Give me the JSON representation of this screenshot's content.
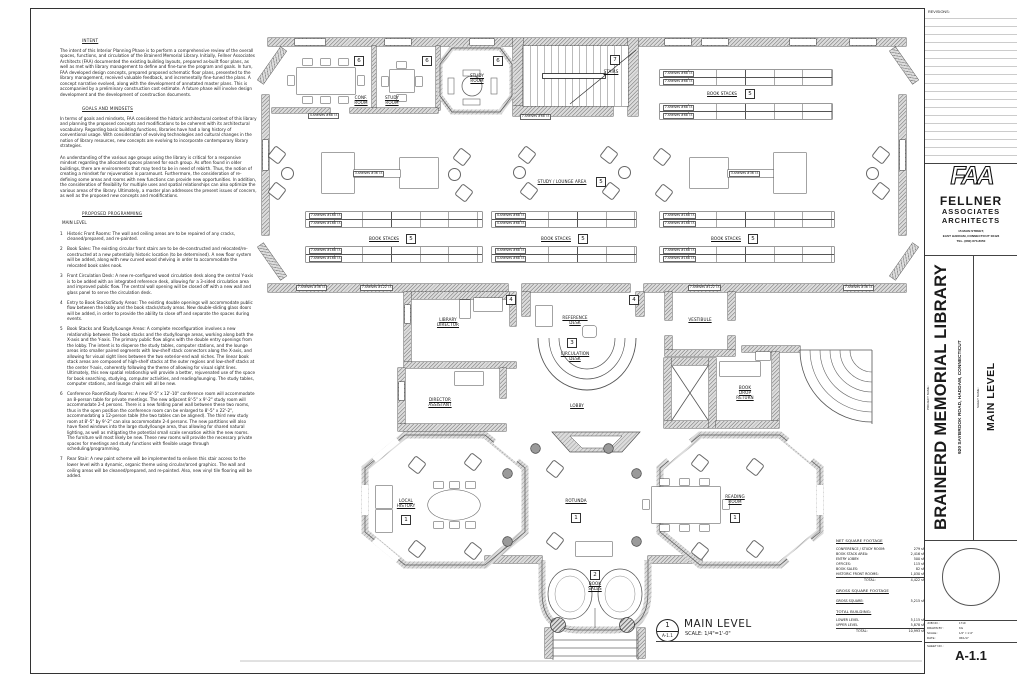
{
  "narrative": {
    "intent_heading": "INTENT",
    "intent_body": "The intent of this Interior Planning Phase is to perform a comprehensive review of the overall spaces, functions, and circulation of the Brainerd Memorial Library.  Initially, Fellner Associates Architects (FAA) documented the existing building layouts, prepared as-built floor plans, as well as met with library management to define and fine-tune the program and goals.  In turn, FAA developed design concepts, prepared proposed schematic floor plans, presented to the library management, received valuable feedback, and incrementally fine-tuned the plans.  A concept narrative evolved, along with the development of annotated master plans.  This is accompanied by a preliminary construction cost estimate.  A future phase will involve design development and the development of construction documents.",
    "goals_heading": "GOALS AND MINDSETS",
    "goals_body_1": "In terms of goals and mindsets, FAA considered the historic architectural context of this library and planning the proposed concepts and modifications to be coherent with its architectural vocabulary.  Regarding basic building functions, libraries have had a long history of conventional usage.  With consideration of evolving technologies and cultural changes in the notion of library resources, new concepts are evolving to incorporate contemporary library strategies.",
    "goals_body_2": "An understanding of the various age groups using the library is critical for a responsive mindset regarding the allocated spaces planned for each group.  As often found in older buildings, there are environments that may tend to be in need of rebirth.  Thus, the notion of creating a mindset for rejuvenation is paramount.  Furthermore, the consideration of re-defining some areas and rooms with new functions can provide new opportunities.  In addition, the consideration of flexibility for multiple uses and spatial relationships can also optimize the various areas of the library.  Ultimately, a master plan addresses the present issues of concern, as well as the proposed new concepts and modifications.",
    "programming_heading": "PROPOSED PROGRAMMING",
    "main_level_heading": "MAIN LEVEL",
    "items": [
      {
        "n": "1",
        "t": "Historic Front Rooms:  The wall and ceiling areas are to be repaired of any cracks, cleaned/prepared, and re-painted."
      },
      {
        "n": "2",
        "t": "Book Sales:  The existing circular front stairs are to be de-constructed and relocated/re-constructed at a new potentially historic location (to be determined).  A new floor system will be added, along with new curved wood shelving in order to accommodate the relocated book sales nook."
      },
      {
        "n": "3",
        "t": "Front Circulation Desk:  A new re-configured wood circulation desk along the central Y-axis is to be added with an integrated reference desk, allowing for a 3-sided circulation area and improved public flow.  The central wall opening will be closed off with a new wall and glass panel to serve the circulation desk."
      },
      {
        "n": "4",
        "t": "Entry to Book Stacks/Study Areas:  The existing double openings will accommodate public flow between the lobby and the book stacks/study areas.  New double-sliding glass doors will be added, in order to provide the ability to close off and separate the spaces during events."
      },
      {
        "n": "5",
        "t": "Book Stacks and Study/Lounge Areas:  A complete reconfiguration involves a new relationship between the book stacks and the study/lounge areas, working along both the X-axis and the Y-axis.  The primary public flow aligns with the double entry openings from the lobby.  The intent is to disperse the study tables, computer stations, and the lounge areas into smaller paired segments with low-shelf stack connectors along the X-axis, and allowing for visual sight lines between the two exterior-end wall niches.  The linear book stack areas are composed of high-shelf stacks at the outer regions and low-shelf stacks at the center Y-axis, coherently following the theme of allowing for visual sight lines.  Ultimately, this new spatial relationship will provide a better, rejuvenated use of the space for book searching, studying, computer activities, and reading/lounging.  The study tables, computer stations, and lounge chairs will all be new."
      },
      {
        "n": "6",
        "t": "Conference Room/Study Rooms:  A new 8'-5\" x 12'-10\" conference room will accommodate an 8-person table for private meetings.  The new adjacent 8'-5\" x 9'-2\" study room will accommodate 2-4 persons.  There is a new folding panel wall between these two rooms, thus in the open position the conference room can be enlarged to 8'-5\" x 22'-2\", accommodating a 12-person table (the two tables can be aligned).  The third new study room at 8'-5\" by 9'-2\" can also accommodate 2-4 persons.  The new partitions will also have fixed windows into the large study/lounge area, thus allowing for shared natural lighting, as well as mitigating the potential small scale sensation within the new rooms.  The furniture will most likely be new.  These new rooms will provide the necessary private spaces for meetings and study functions with flexible usage through scheduling/programming."
      },
      {
        "n": "7",
        "t": "Rear Stair:  A new paint scheme will be implemented to enliven this stair access to the lower level with a dynamic, organic theme using circular/arced graphics.  The wall and ceiling areas will be cleaned/prepared, and re-painted.  Also, new vinyl tile flooring will be added."
      }
    ]
  },
  "plan": {
    "view": {
      "ref_num": "1",
      "ref_sheet": "A-1.1",
      "title": "MAIN LEVEL",
      "scale": "SCALE:  1/4\"=1'-0\""
    },
    "rooms": {
      "conf_room": "CONF.\nROOM",
      "study_room": "STUDY\nROOM",
      "stairs": "STAIRS",
      "study_lounge": "STUDY / LOUNGE AREA",
      "book_stacks": "BOOK STACKS",
      "library_director": "LIBRARY\nDIRECTOR",
      "director_assistant": "DIRECTOR\nASSISTANT",
      "reference_desk": "REFERENCE\nDESK",
      "circulation_desk": "CIRCULATION\nDESK",
      "lobby": "LOBBY",
      "vestibule": "VESTIBULE",
      "book_drop": "BOOK\nDROP\nRETURN",
      "local_history": "LOCAL\nHISTORY",
      "rotunda": "ROTUNDA",
      "reading_room": "READING\nROOM",
      "book_sales": "BOOK\nSALES"
    },
    "keys": {
      "k1": "1",
      "k2": "2",
      "k3": "3",
      "k4": "4",
      "k5": "5",
      "k6": "6",
      "k7": "7"
    },
    "shelves": {
      "s3_36": "3-shelves #36 l.f.",
      "s4_68": "4-shelves #68 l.f.",
      "s7_68": "7-shelves #68 l.f.",
      "s7_168": "7-shelves #168 l.f.",
      "s7_122": "7-shelves #122 l.f.",
      "s7_36": "7-shelves #36 l.f."
    }
  },
  "area_table": {
    "net_heading": "NET SQUARE FOOTAGE",
    "net_rows": [
      [
        "CONFERENCE / STUDY ROOM:",
        "279 sf"
      ],
      [
        "BOOK STACK AREA:",
        "2,416 sf"
      ],
      [
        "ENTRY LOBBY:",
        "500 sf"
      ],
      [
        "OFFICES:",
        "115 sf"
      ],
      [
        "BOOK SALES:",
        "82 sf"
      ],
      [
        "HISTORIC FRONT ROOMS:",
        "1,030 sf"
      ]
    ],
    "net_total": [
      "TOTAL:",
      "4,422 sf"
    ],
    "gross_heading": "GROSS SQUARE FOOTAGE",
    "gross_row": [
      "GROSS SQUARE:",
      "5,215 sf"
    ],
    "building_heading": "TOTAL BUILDING:",
    "building_rows": [
      [
        "LOWER LEVEL",
        "5,115 sf"
      ],
      [
        "UPPER LEVEL",
        "5,878 sf"
      ],
      [
        "TOTAL:",
        "10,993 sf"
      ]
    ]
  },
  "titleblock": {
    "revisions_label": "REVISIONS:",
    "logo_text": "FAA",
    "firm_name_1": "FELLNER",
    "firm_name_2": "ASSOCIATES",
    "firm_name_3": "ARCHITECTS",
    "firm_address_1": "15 MAIN STREET,",
    "firm_address_2": "EAST HADDAM, CONNECTICUT 06423",
    "firm_phone": "TEL. (860) 873-8050",
    "project_name_label": "PROJECT NAME :",
    "project_name": "BRAINERD MEMORIAL LIBRARY",
    "project_address": "920 SAYBROOK ROAD, HADDAM, CONNECTICUT",
    "sheet_name_label": "SHEET NAME :",
    "sheet_name": "MAIN LEVEL",
    "job_no_label": "JOB NO. :",
    "job_no": "1719",
    "drawn_by_label": "DRAWN BY :",
    "drawn_by": "KG",
    "scale_label": "SCALE :",
    "scale": "1/4\" = 1'-0\"",
    "date_label": "DATE :",
    "date": "06/1/17",
    "sheet_no_label": "SHEET NO. :",
    "sheet_no": "A-1.1"
  }
}
